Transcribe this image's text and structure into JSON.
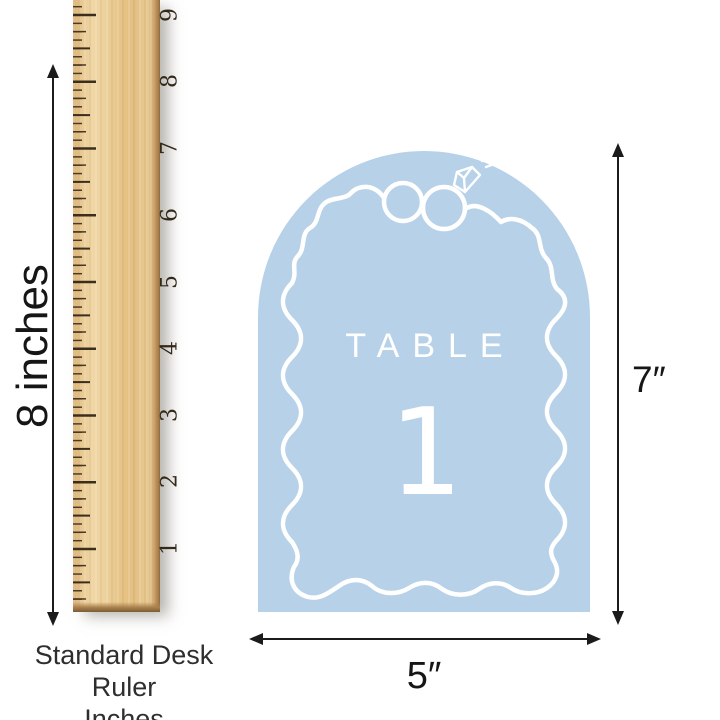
{
  "page": {
    "background_color": "#ffffff"
  },
  "ruler": {
    "numbers": [
      "9",
      "8",
      "7",
      "6",
      "5",
      "4",
      "3",
      "2",
      "1"
    ],
    "height_label": "8 inches",
    "caption_line1": "Standard Desk Ruler",
    "caption_line2": "Inches",
    "wood_color": "#e6c58c",
    "tick_color": "#3b2e1d"
  },
  "card": {
    "title": "TABLE",
    "number": "1",
    "background_color": "#b7d2e8",
    "line_color": "#ffffff",
    "icons": [
      "wedding-rings-icon",
      "diamond-icon"
    ]
  },
  "dimensions": {
    "height_label": "7″",
    "width_label": "5″",
    "arrow_color": "#1b1b1b"
  }
}
